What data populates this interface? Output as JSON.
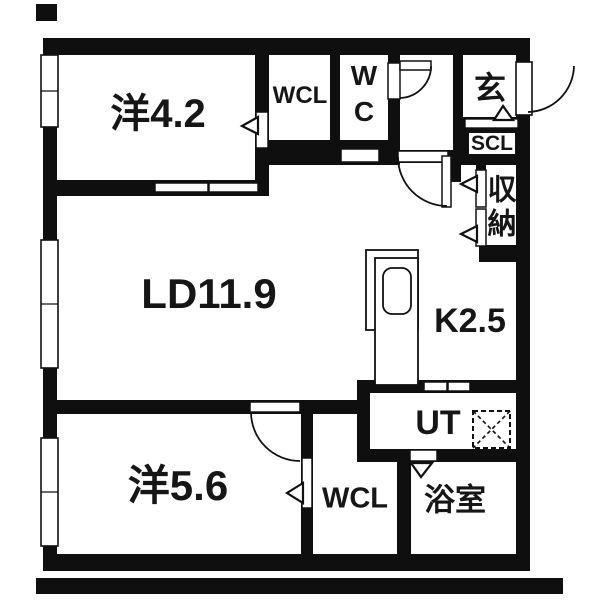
{
  "plan": {
    "type": "apartment-floor-plan",
    "colors": {
      "wall": "#0f0f0f",
      "floor": "#ffffff",
      "line": "#111111"
    },
    "rooms": {
      "western_top": {
        "label": "洋4.2"
      },
      "wcl_top": {
        "label": "WCL"
      },
      "wc": {
        "line1": "W",
        "line2": "C"
      },
      "entrance": {
        "label": "玄"
      },
      "scl": {
        "label": "SCL"
      },
      "storage": {
        "char1": "収",
        "char2": "納"
      },
      "living_dining": {
        "label": "LD11.9"
      },
      "kitchen": {
        "label": "K2.5"
      },
      "utility": {
        "label": "UT"
      },
      "bathroom": {
        "label": "浴室"
      },
      "western_bottom": {
        "label": "洋5.6"
      },
      "wcl_bottom": {
        "label": "WCL"
      }
    }
  }
}
